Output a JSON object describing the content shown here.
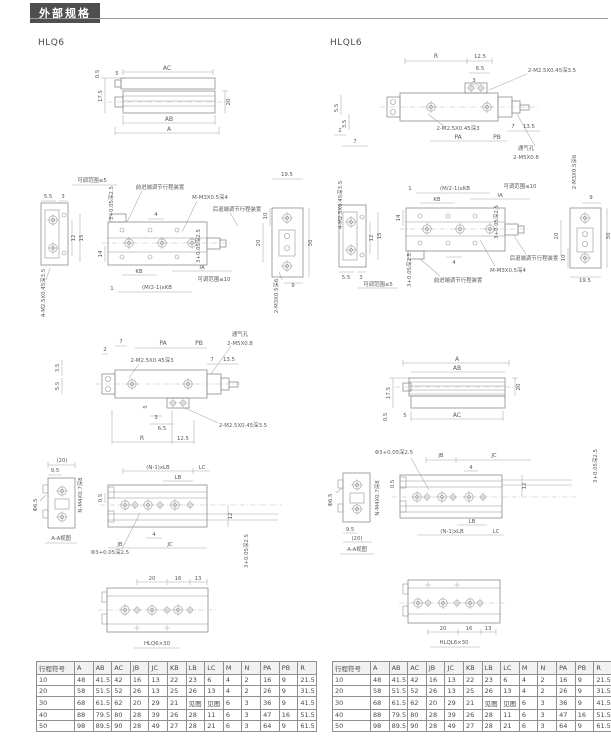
{
  "header": {
    "title": "外部规格"
  },
  "models": {
    "left": "HLQ6",
    "right": "HLQL6"
  },
  "side_view": {
    "a": "A",
    "ab": "AB",
    "ac": "AC",
    "d05": "0.5",
    "d5": "5",
    "d175": "17.5",
    "d20": "20"
  },
  "plan_view": {
    "adj5": "可调范围≤5",
    "adj10": "可调范围≤10",
    "fwd": "前进端调节行程装置",
    "rear": "后退端调节行程装置",
    "m3d4": "M-M3X0.5深4",
    "m3d6": "2-M3X0.5深6",
    "m25d35": "4-M2.5X0.45深3.5",
    "tol": "3+0.05深2.5",
    "ia": "IA",
    "kb": "KB",
    "mkb": "(M/2-1)xKB",
    "d1": "1",
    "d3": "3",
    "d4": "4",
    "d9": "9",
    "d10": "10",
    "d12": "12",
    "d14": "14",
    "d15": "15",
    "d20": "20",
    "d30": "30",
    "d55": "5.5",
    "d195": "19.5"
  },
  "front_view": {
    "pa": "PA",
    "pb": "PB",
    "r": "R",
    "vent": "通气孔",
    "m5": "2-M5X0.8",
    "m25d3": "2-M2.5X0.45深3",
    "m25d35": "2-M2.5X0.45深3.5",
    "d2": "2",
    "d3": "3",
    "d35": "3.5",
    "d5": "5",
    "d55": "5.5",
    "d65": "6.5",
    "d7": "7",
    "d125": "12.5",
    "d135": "13.5"
  },
  "aa_view": {
    "caption": "A-A视图",
    "phi65": "Φ6.5",
    "phi3": "Φ3+0.05深2.5",
    "tol3": "3+0.05深2.5",
    "nm4": "N-M4X0.7深8",
    "nlb": "(N-1)xLB",
    "jb": "JB",
    "jc": "JC",
    "lb": "LB",
    "lc": "LC",
    "d05": "0.5",
    "d4": "4",
    "d95": "9.5",
    "d12": "12",
    "d20p": "(20)"
  },
  "detail_view": {
    "d20": "20",
    "d16": "16",
    "d13": "13",
    "left_caption": "HLQ6×30",
    "right_caption": "HLQL6×30"
  },
  "table": {
    "headers": [
      "行程符号",
      "A",
      "AB",
      "AC",
      "JB",
      "JC",
      "KB",
      "LB",
      "LC",
      "M",
      "N",
      "PA",
      "PB",
      "R"
    ],
    "rows": [
      [
        "10",
        "48",
        "41.5",
        "42",
        "16",
        "13",
        "22",
        "23",
        "6",
        "4",
        "2",
        "16",
        "9",
        "21.5"
      ],
      [
        "20",
        "58",
        "51.5",
        "52",
        "26",
        "13",
        "25",
        "26",
        "13",
        "4",
        "2",
        "26",
        "9",
        "31.5"
      ],
      [
        "30",
        "68",
        "61.5",
        "62",
        "20",
        "29",
        "21",
        "见图",
        "见图",
        "6",
        "3",
        "36",
        "9",
        "41.5"
      ],
      [
        "40",
        "88",
        "79.5",
        "80",
        "28",
        "39",
        "26",
        "28",
        "11",
        "6",
        "3",
        "47",
        "16",
        "51.5"
      ],
      [
        "50",
        "98",
        "89.5",
        "90",
        "28",
        "49",
        "27",
        "28",
        "21",
        "6",
        "3",
        "64",
        "9",
        "61.5"
      ]
    ]
  }
}
